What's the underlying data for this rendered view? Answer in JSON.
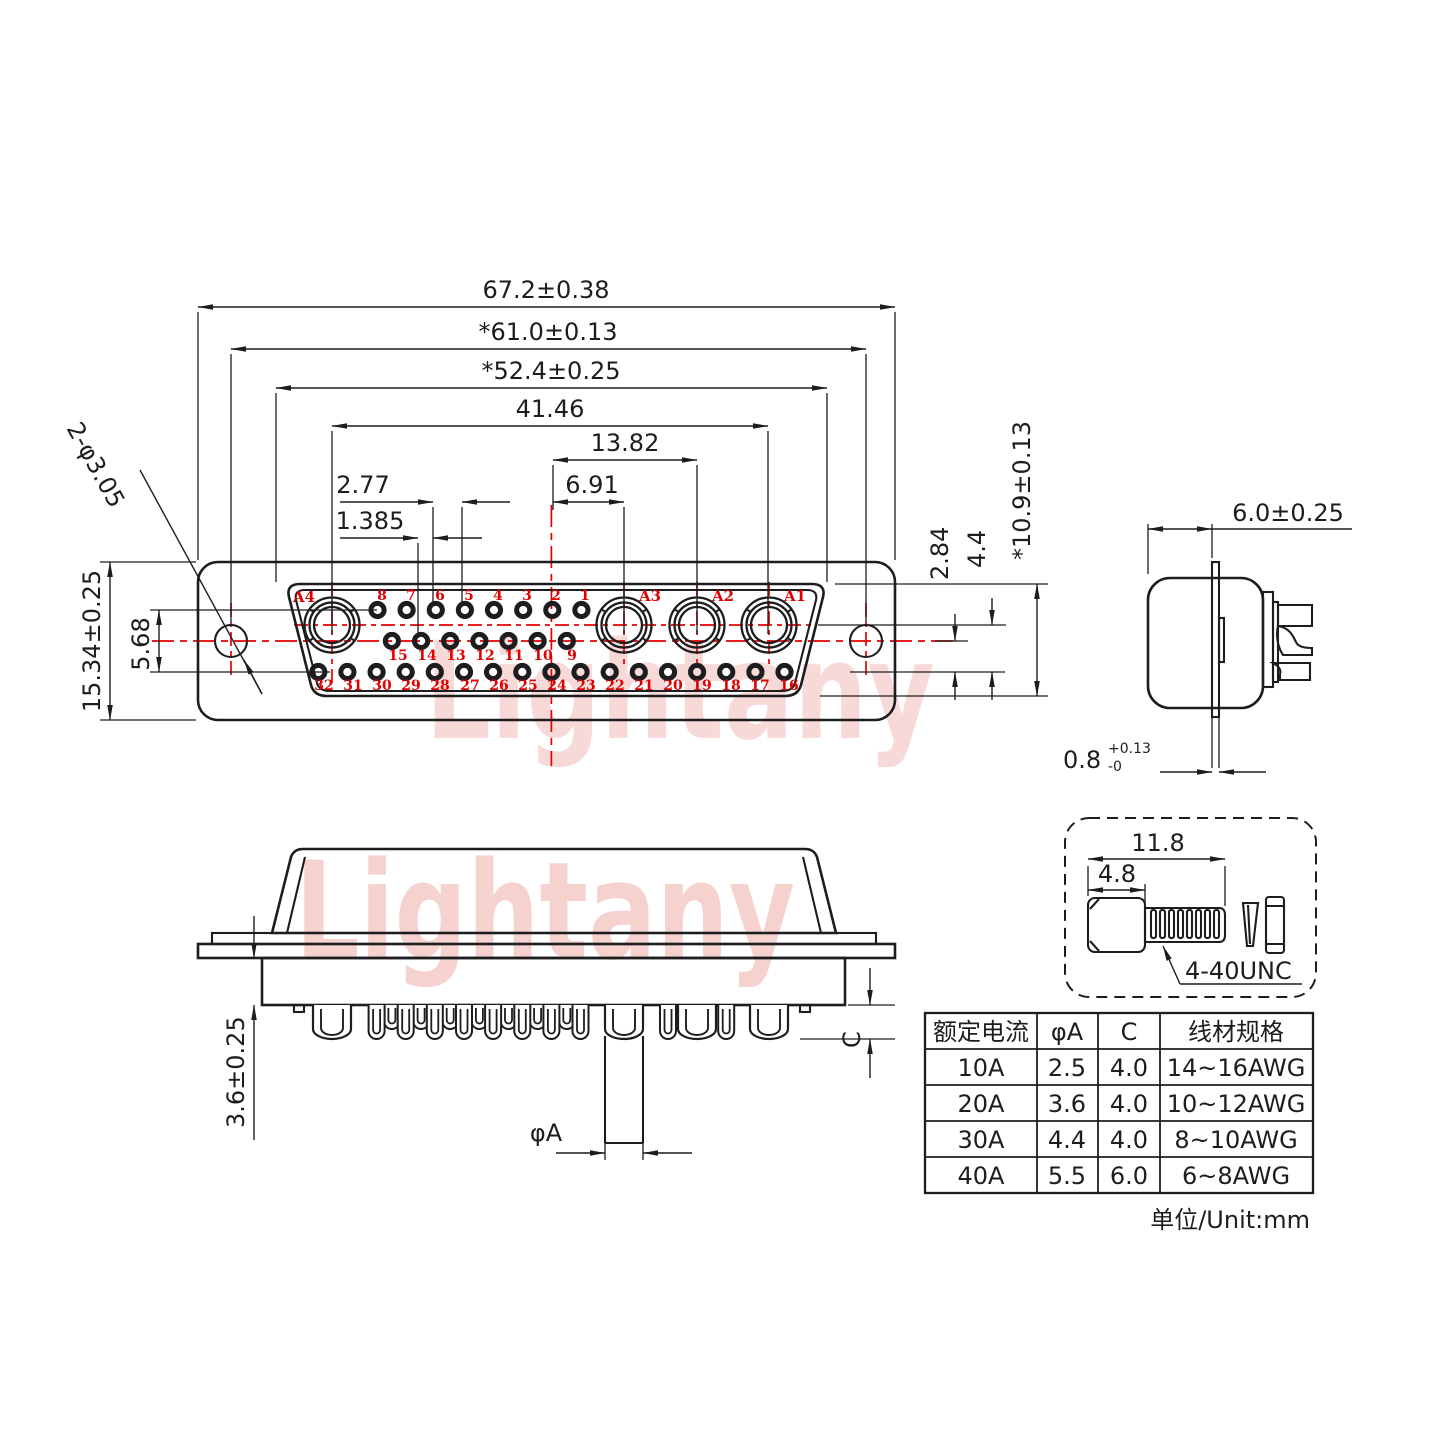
{
  "front_view": {
    "dims": {
      "overall_width": "67.2±0.38",
      "hole_span": "*61.0±0.13",
      "shroud_width": "*52.4±0.25",
      "a_pin_span": "41.46",
      "pair_span": "13.82",
      "half_pair": "6.91",
      "pin_pitch": "2.77",
      "half_pitch": "1.385",
      "flange_height": "15.34±0.25",
      "row_span": "5.68",
      "mount_hole": "2-φ3.05",
      "row_pitch": "2.84",
      "socket_row_depth": "4.4",
      "shroud_height": "*10.9±0.13"
    },
    "socket_labels": [
      "A4",
      "A3",
      "A2",
      "A1"
    ],
    "pins_top": [
      "8",
      "7",
      "6",
      "5",
      "4",
      "3",
      "2",
      "1"
    ],
    "pins_mid": [
      "15",
      "14",
      "13",
      "12",
      "11",
      "10",
      "9"
    ],
    "pins_bottom": [
      "32",
      "31",
      "30",
      "29",
      "28",
      "27",
      "26",
      "25",
      "24",
      "23",
      "22",
      "21",
      "20",
      "19",
      "18",
      "17",
      "16"
    ]
  },
  "side_view": {
    "depth": "6.0±0.25",
    "flange_thickness": "0.8",
    "flange_tol_plus": "+0.13",
    "flange_tol_minus": "-0"
  },
  "bottom_view": {
    "standoff": "3.6±0.25",
    "pin_dia_label": "φA",
    "cup_depth_label": "C"
  },
  "screw_detail": {
    "overall_length": "11.8",
    "head_length": "4.8",
    "thread_label": "4-40UNC"
  },
  "spec_table": {
    "headers": [
      "额定电流",
      "φA",
      "C",
      "线材规格"
    ],
    "rows": [
      [
        "10A",
        "2.5",
        "4.0",
        "14~16AWG"
      ],
      [
        "20A",
        "3.6",
        "4.0",
        "10~12AWG"
      ],
      [
        "30A",
        "4.4",
        "4.0",
        "8~10AWG"
      ],
      [
        "40A",
        "5.5",
        "6.0",
        "6~8AWG"
      ]
    ]
  },
  "unit_note": "单位/Unit:mm",
  "watermark": "Lightany",
  "colors": {
    "line": "#1d1d1f",
    "accent_red": "#e80000",
    "watermark_pink": "#f6d2cf"
  }
}
